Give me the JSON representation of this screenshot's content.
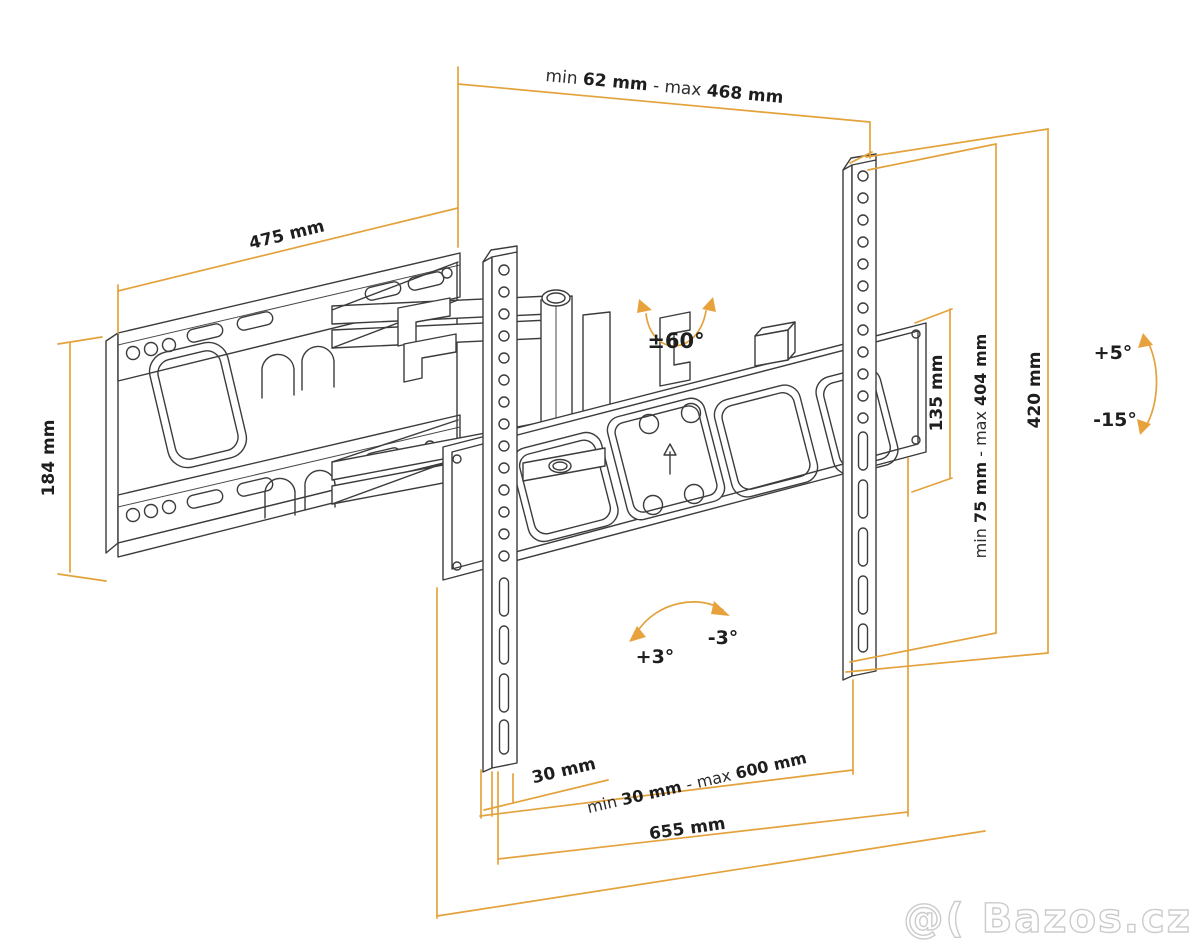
{
  "title": "Full-motion TV wall mount dimensional drawing",
  "colors": {
    "dimension_line": "#E3A23C",
    "drawing_line": "#3C3C3C",
    "label_text": "#1E1E1E",
    "watermark_outline": "#CBCBCB",
    "background": "#FFFFFF"
  },
  "dimensions": {
    "top_width": {
      "prefix": "min ",
      "min": "62 mm",
      "mid": " - max ",
      "max": "468 mm",
      "full": "min 62 mm - max 468 mm",
      "min_mm": 62,
      "max_mm": 468
    },
    "arm_reach": {
      "label": "475 mm",
      "value_mm": 475
    },
    "wall_plate_height": {
      "label": "184 mm",
      "value_mm": 184
    },
    "vesa_plate_height": {
      "label": "135 mm",
      "value_mm": 135
    },
    "bracket_height_range": {
      "prefix": "min ",
      "min": "75 mm",
      "mid": " - max ",
      "max": "404 mm",
      "full": "min 75 mm - max 404 mm",
      "min_mm": 75,
      "max_mm": 404
    },
    "rail_height": {
      "label": "420 mm",
      "value_mm": 420
    },
    "rail_inset": {
      "label": "30 mm",
      "value_mm": 30
    },
    "rail_spacing_range": {
      "prefix": "min ",
      "min": "30 mm",
      "mid": " - max ",
      "max": "600 mm",
      "full": "min 30 mm - max 600 mm",
      "min_mm": 30,
      "max_mm": 600
    },
    "crossbar_width": {
      "label": "655 mm",
      "value_mm": 655
    }
  },
  "angles": {
    "swivel": {
      "label": "±60°"
    },
    "tilt_up": {
      "label": "+5°"
    },
    "tilt_down": {
      "label": "-15°"
    },
    "level_plus": {
      "label": "+3°"
    },
    "level_minus": {
      "label": "-3°"
    }
  },
  "watermark": {
    "text": "@( Bazos.cz"
  }
}
